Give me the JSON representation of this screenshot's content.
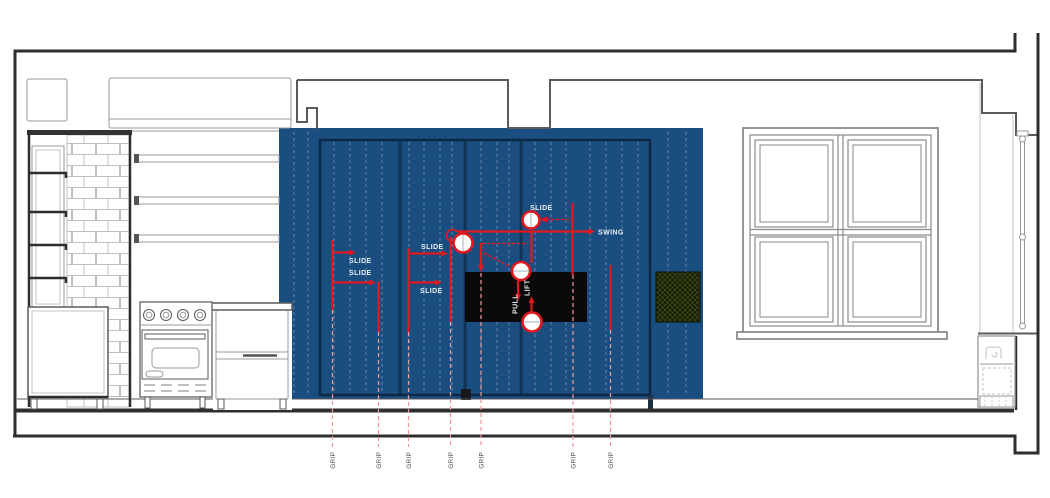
{
  "colors": {
    "panel-blue": "#1b4e80",
    "panel-blue-dark": "#0f3355",
    "outline-navy": "#0c2844",
    "annotation-red": "#e0181f",
    "grip-pink": "#ef9a9a",
    "tv-black": "#0a0a0a",
    "vent-green": "#161c06",
    "vent-hatch": "#3d4b15",
    "line-dark": "#2e2e2e",
    "line-mid": "#5a5a5a",
    "line-light": "#9a9a9a",
    "brick-line": "#c0c0c0",
    "label-light": "#e9edf2",
    "label-dark": "#4c4c4c"
  },
  "annotations": {
    "slide_labels": [
      "SLIDE",
      "SLIDE",
      "SLIDE",
      "SLIDE",
      "SLIDE"
    ],
    "swing_label": "SWING",
    "pull_label": "PULL",
    "lift_label": "LIFT",
    "grip_labels": [
      "GRIP",
      "GRIP",
      "GRIP",
      "GRIP",
      "GRIP",
      "GRIP",
      "GRIP"
    ]
  }
}
